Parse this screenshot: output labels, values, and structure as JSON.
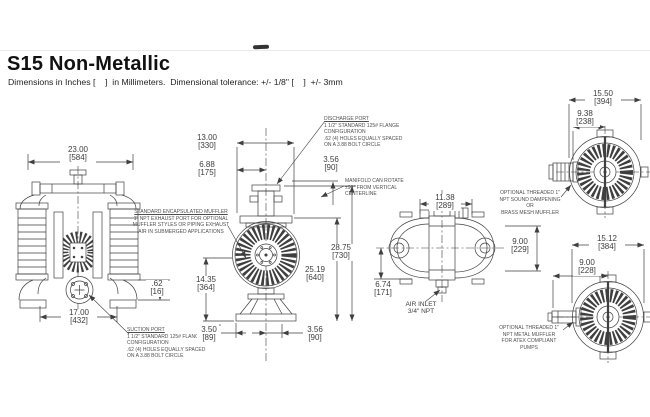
{
  "colors": {
    "background": "#ffffff",
    "line_art": "#3f3f3f",
    "title_text": "#111111",
    "dim_text": "#3d3d3d",
    "note_text": "#4f4f4f",
    "divider": "#ebebeb"
  },
  "header": {
    "title": "S15 Non-Metallic",
    "subtitle": "Dimensions in Inches [    ]  in Millimeters.  Dimensional tolerance: +/- 1/8\" [    ]  +/- 3mm"
  },
  "front_view": {
    "dim_width_in": "23.00",
    "dim_width_mm": "[584]",
    "dim_offset_in": ".62",
    "dim_offset_mm": "[16]",
    "dim_footprint_in": "17.00",
    "dim_footprint_mm": "[432]",
    "muffler_note": [
      "STANDARD ENCAPSULATED  MUFFLER",
      "1\" NPT EXHAUST PORT FOR OPTIONAL",
      "MUFFLER STYLES OR PIPING EXHAUST",
      "AIR IN SUBMERGED APPLICATIONS"
    ],
    "suction_note": [
      "SUCTION PORT",
      "1 1/2\" STANDARD 125# FLANGE",
      "CONFIGURATION",
      ".62 (4) HOLES EQUALLY SPACED",
      "ON A 3.88 BOLT CIRCLE"
    ]
  },
  "profile_view": {
    "dim_depth_in": "13.00",
    "dim_depth_mm": "[330]",
    "dim_688_in": "6.88",
    "dim_688_mm": "[175]",
    "dim_356_top_in": "3.56",
    "dim_356_top_mm": "[90]",
    "dim_1435_in": "14.35",
    "dim_1435_mm": "[364]",
    "dim_2519_in": "25.19",
    "dim_2519_mm": "[640]",
    "dim_2875_in": "28.75",
    "dim_2875_mm": "[730]",
    "dim_350_in": "3.50",
    "dim_350_mm": "[89]",
    "dim_356_bot_in": "3.56",
    "dim_356_bot_mm": "[90]",
    "discharge_note": [
      "DISCHARGE PORT",
      "1 1/2\" STANDARD 125# FLANGE",
      "CONFIGURATION",
      ".62 (4) HOLES EQUALLY SPACED",
      "ON A 3.88 BOLT CIRCLE"
    ],
    "manifold_note": [
      "MANIFOLD CAN ROTATE",
      "±90° FROM VERTICAL",
      "CENTERLINE"
    ]
  },
  "top_view": {
    "dim_width_in": "11.38",
    "dim_width_mm": "[289]",
    "dim_674_in": "6.74",
    "dim_674_mm": "[171]",
    "dim_height_in": "9.00",
    "dim_height_mm": "[229]",
    "air_inlet_note": [
      "AIR INLET",
      "3/4\" NPT"
    ]
  },
  "muffler_view_sound": {
    "dim_width_in": "15.50",
    "dim_width_mm": "[394]",
    "dim_938_in": "9.38",
    "dim_938_mm": "[238]",
    "note": [
      "OPTIONAL THREADED 1\"",
      "NPT SOUND DAMPENING OR",
      "BRASS MESH MUFFLER"
    ]
  },
  "muffler_view_atex": {
    "dim_width_in": "15.12",
    "dim_width_mm": "[384]",
    "dim_900_in": "9.00",
    "dim_900_mm": "[228]",
    "note": [
      "OPTIONAL THREADED 1\"",
      "NPT METAL MUFFLER",
      "FOR ATEX COMPLIANT PUMPS"
    ]
  }
}
